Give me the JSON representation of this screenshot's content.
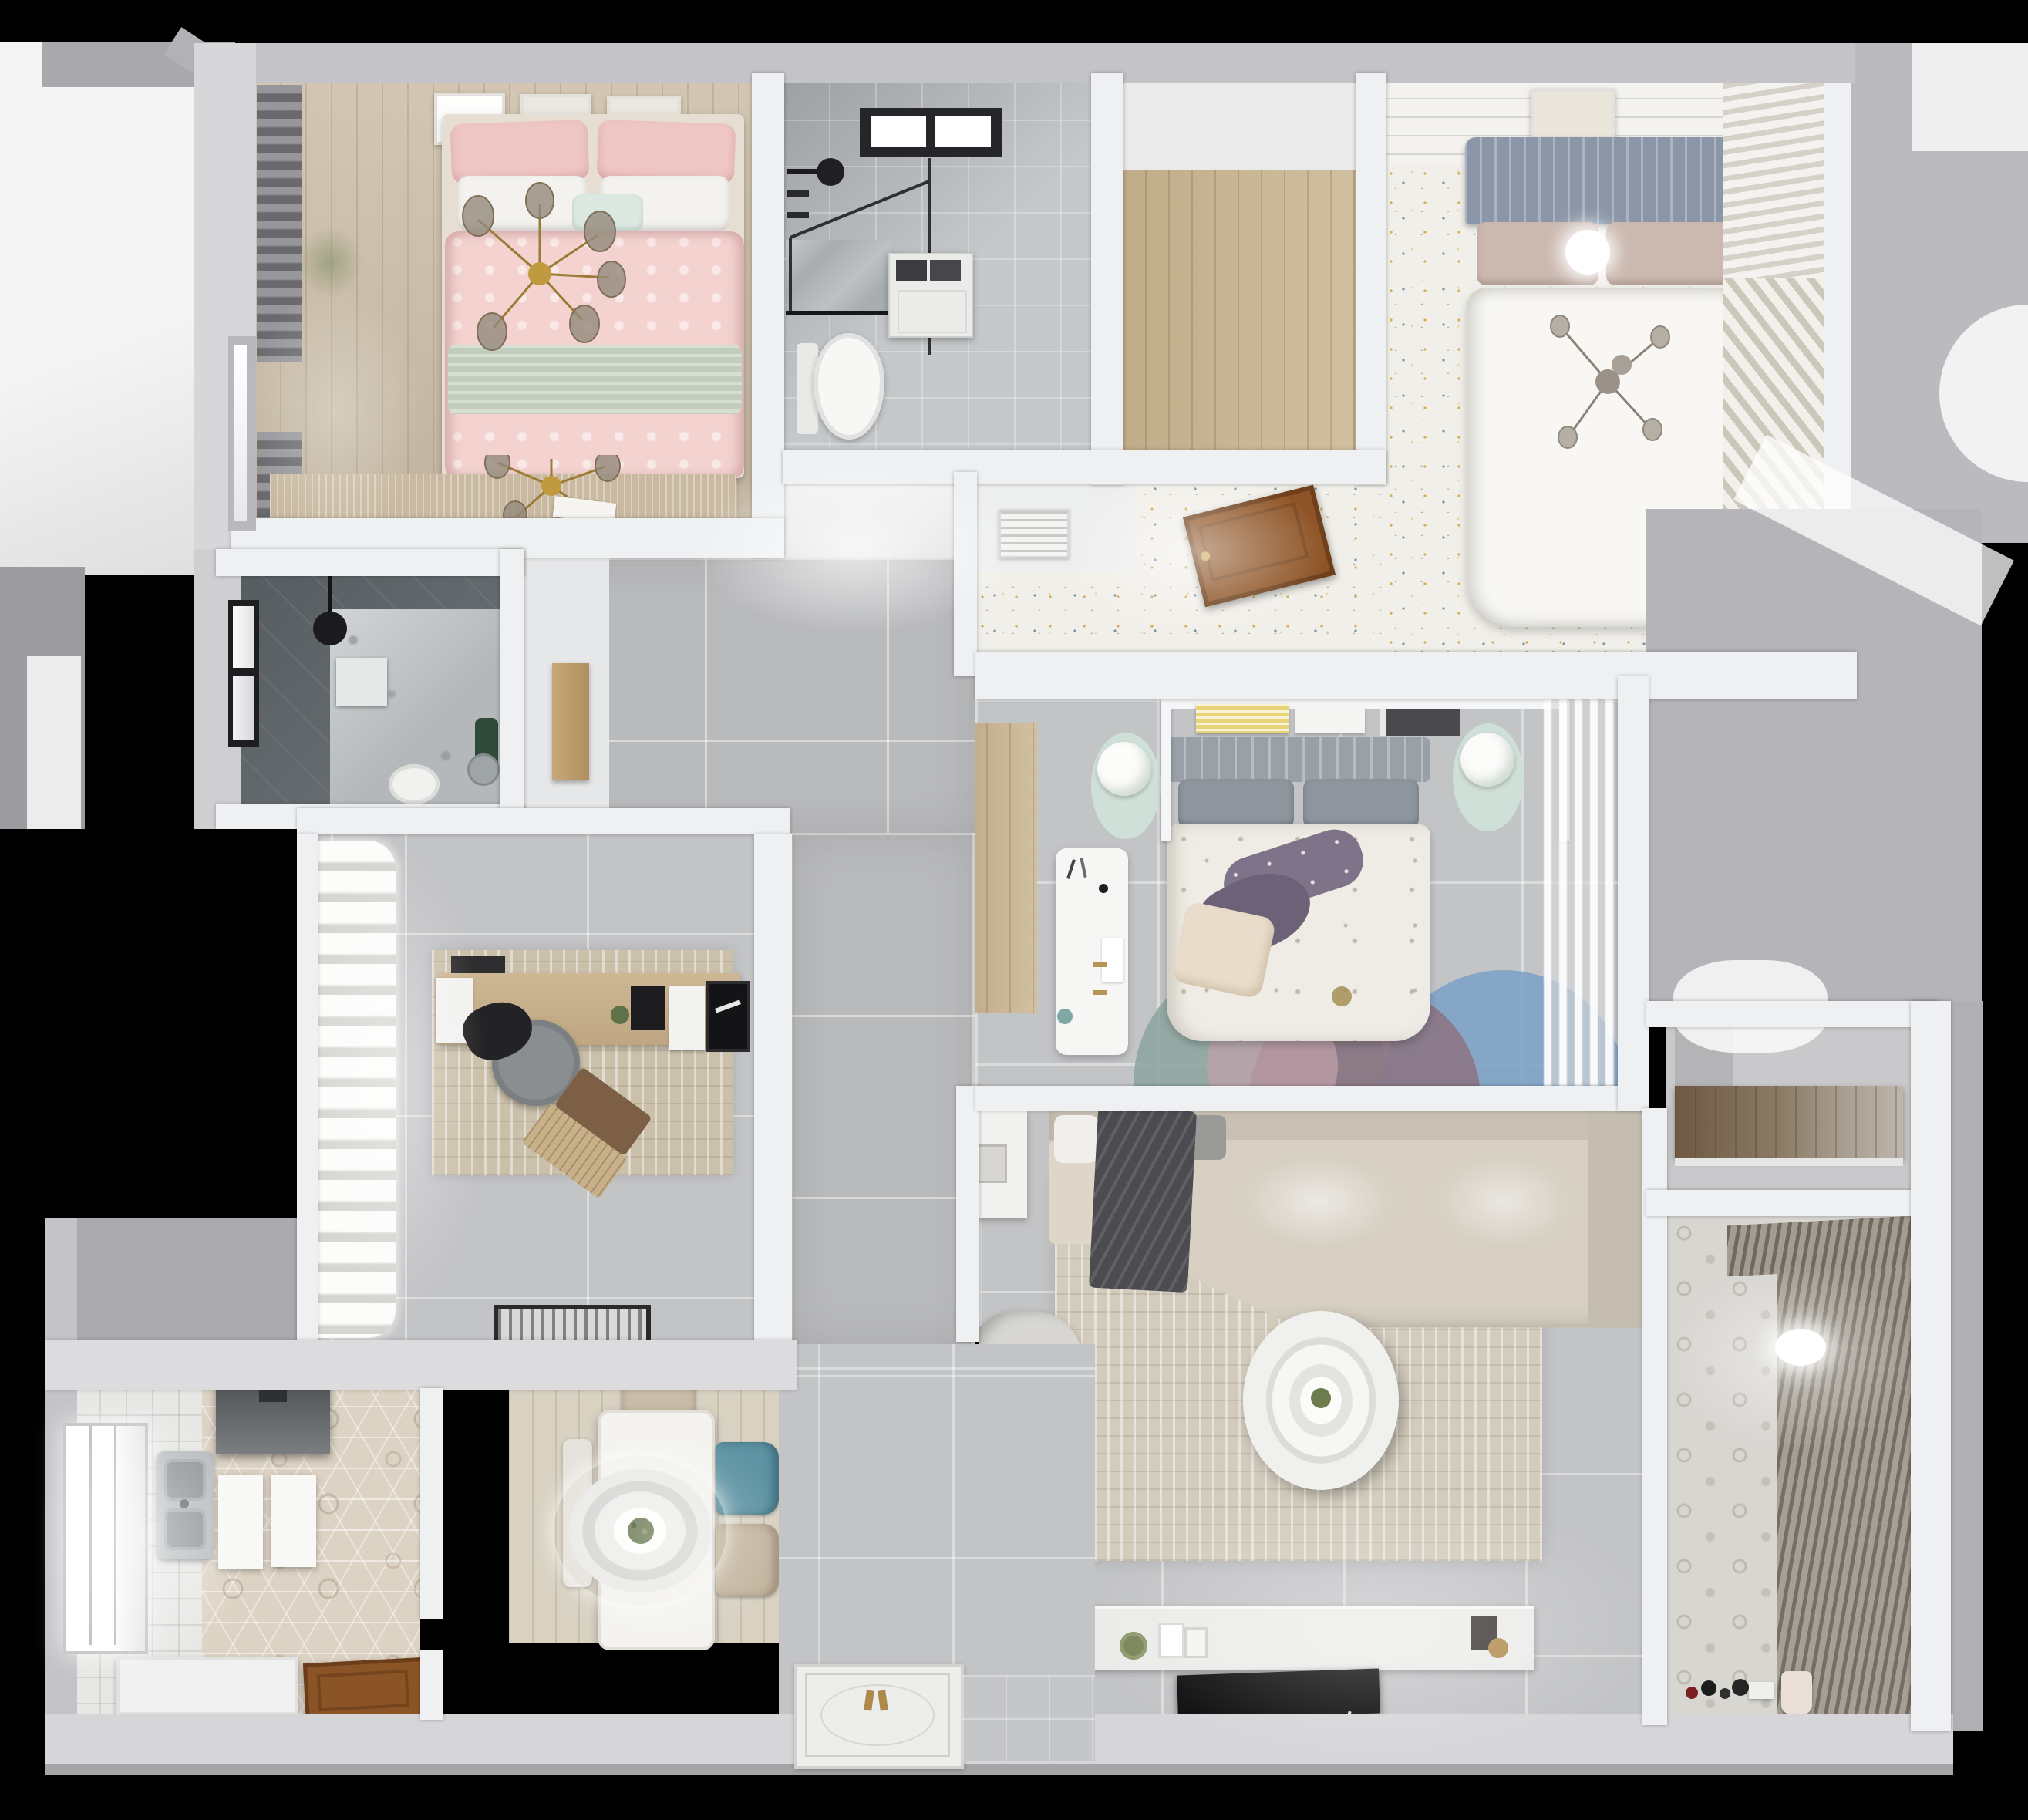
{
  "meta": {
    "title": "Top-down 3D render of a furnished apartment floor plan",
    "view": "overhead dollhouse render",
    "background": "#000000"
  },
  "palette": {
    "outer_wall": "#c4c4c8",
    "inner_wall": "#eef0f2",
    "corridor_tile": "#b9babc",
    "living_tile": "#c3c4c6",
    "bedroom_wood": "#cdbfa9",
    "speckle_floor": "#f1efe9",
    "hex_tile": "#ddd3c4",
    "pink_bedding": "#f3d2d0",
    "sage_throw": "#c2cdbd",
    "gold_fixture": "#c09a3f",
    "teal_chair": "#5d93a3",
    "mint_rug": "#cfe0d8",
    "purple_pillow": "#7f7389",
    "blue_rug_circle": "#7fa3c7",
    "teal_rug_circle": "#8fa6a1",
    "mauve_rug_circle": "#8b7280",
    "wood_door": "#8a5427",
    "dark_bath_wall": "#5f666a",
    "tv_black": "#0c0c0e"
  },
  "rooms": [
    {
      "id": "bedroom-pink",
      "label": "Bedroom with pink bedding",
      "furniture": [
        "double bed",
        "pink pillows",
        "white pillows",
        "sage green throw",
        "branch chandelier",
        "gray curtains",
        "window",
        "three wall art frames",
        "tan rug",
        "open book"
      ]
    },
    {
      "id": "bathroom-top",
      "label": "Bathroom with walk-in shower",
      "furniture": [
        "skylight window",
        "black rain shower head",
        "glass shower screen",
        "shower tray",
        "washing machine",
        "toilet"
      ]
    },
    {
      "id": "closet-wood",
      "label": "Walk-in closet with wood floor",
      "furniture": [
        "wood plank floor"
      ]
    },
    {
      "id": "bedroom-main",
      "label": "Main bedroom with speckled floor",
      "furniture": [
        "double bed",
        "blue-gray slatted headboard",
        "white duvet",
        "ceiling lamp",
        "branch chandelier",
        "art frame",
        "louvered wardrobe",
        "floor vent grille",
        "open wooden door"
      ]
    },
    {
      "id": "hallway",
      "label": "Hallway",
      "furniture": [
        "large gray floor tiles",
        "tall wooden cabinet"
      ]
    },
    {
      "id": "bathroom-dark",
      "label": "Dark tiled shower room",
      "furniture": [
        "window",
        "ceiling shower head",
        "shower tray",
        "toilet",
        "green plant",
        "round mirror"
      ]
    },
    {
      "id": "study",
      "label": "Study",
      "furniture": [
        "white wavy curtains",
        "distressed rug",
        "wooden desk",
        "monitor",
        "papers",
        "desk plant",
        "gray swivel chair",
        "open laptop on chair",
        "black doormat"
      ]
    },
    {
      "id": "bedroom-middle",
      "label": "Middle bedroom",
      "furniture": [
        "double bed",
        "gray headboard",
        "purple accent pillows",
        "cream pillow",
        "floral duvet",
        "white shelf with books",
        "two mint rugs with round side tables",
        "white desk",
        "overlapping circles rug",
        "sheer curtains",
        "wood floor niche"
      ]
    },
    {
      "id": "living-room",
      "label": "Living room",
      "furniture": [
        "L-shaped beige sofa",
        "dark gray blanket",
        "beige rug",
        "round two-tier coffee table",
        "armchair",
        "white side table",
        "TV console with decor",
        "flat black TV",
        "round green clock"
      ]
    },
    {
      "id": "dining",
      "label": "Dining area",
      "furniture": [
        "white dining table",
        "ring pendant lamp with plant centerpiece",
        "teal chair",
        "two beige chairs",
        "bench"
      ]
    },
    {
      "id": "kitchen",
      "label": "Kitchen",
      "furniture": [
        "hexagon tile floor",
        "double stainless sink",
        "white countertops",
        "range hood",
        "window",
        "lower counter",
        "open wooden entry door"
      ]
    },
    {
      "id": "storage-closet",
      "label": "Storage room",
      "furniture": [
        "wooden cabinet"
      ]
    },
    {
      "id": "balcony",
      "label": "Balcony / laundry",
      "furniture": [
        "patterned tile floor",
        "vertical blinds",
        "ceiling lamp",
        "toys",
        "watering can"
      ]
    },
    {
      "id": "entry-hall",
      "label": "Entry hall",
      "furniture": [
        "ornate white threshold mat with gold handles",
        "gray mat"
      ]
    }
  ]
}
